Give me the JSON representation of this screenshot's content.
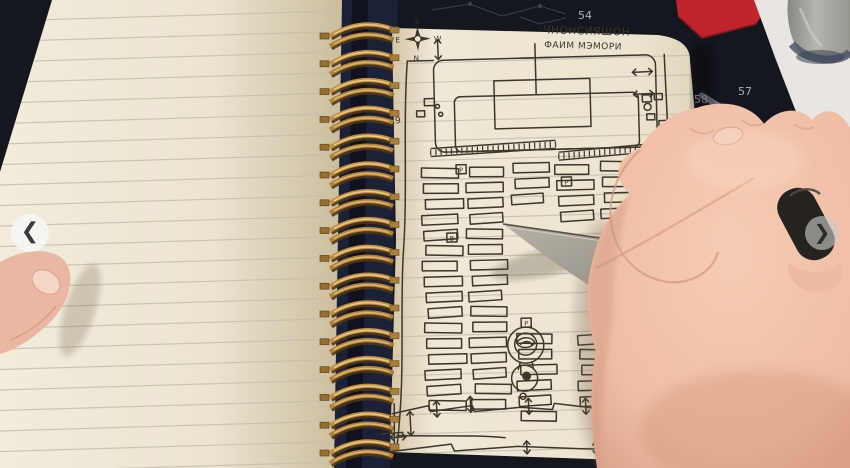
{
  "viewer": {
    "prev_icon": "❮",
    "next_icon": "❯"
  },
  "mat_labels": {
    "n54": "54",
    "n57": "57",
    "n58": "58",
    "n50": "50"
  },
  "sketch": {
    "title_line1": "ЧНОНСИЯШОН",
    "title_line2": "ФАИМ МЭМОРИ",
    "compass": {
      "top": "S",
      "bottom": "N",
      "left": "E",
      "right": "W"
    },
    "labels": {
      "n19": "19",
      "n12": "12",
      "ac": "AC"
    },
    "plot_markers": {
      "m1": "P",
      "m2": "P",
      "m3": "B",
      "m4": "P"
    }
  },
  "colors": {
    "mat": "#14171e",
    "accent_red": "#c0252e",
    "table": "#e9e6e1",
    "page": "#eee7d4",
    "ink": "#3b372d",
    "spiral_gold": "#c08f44",
    "skin": "#eec0a8"
  }
}
